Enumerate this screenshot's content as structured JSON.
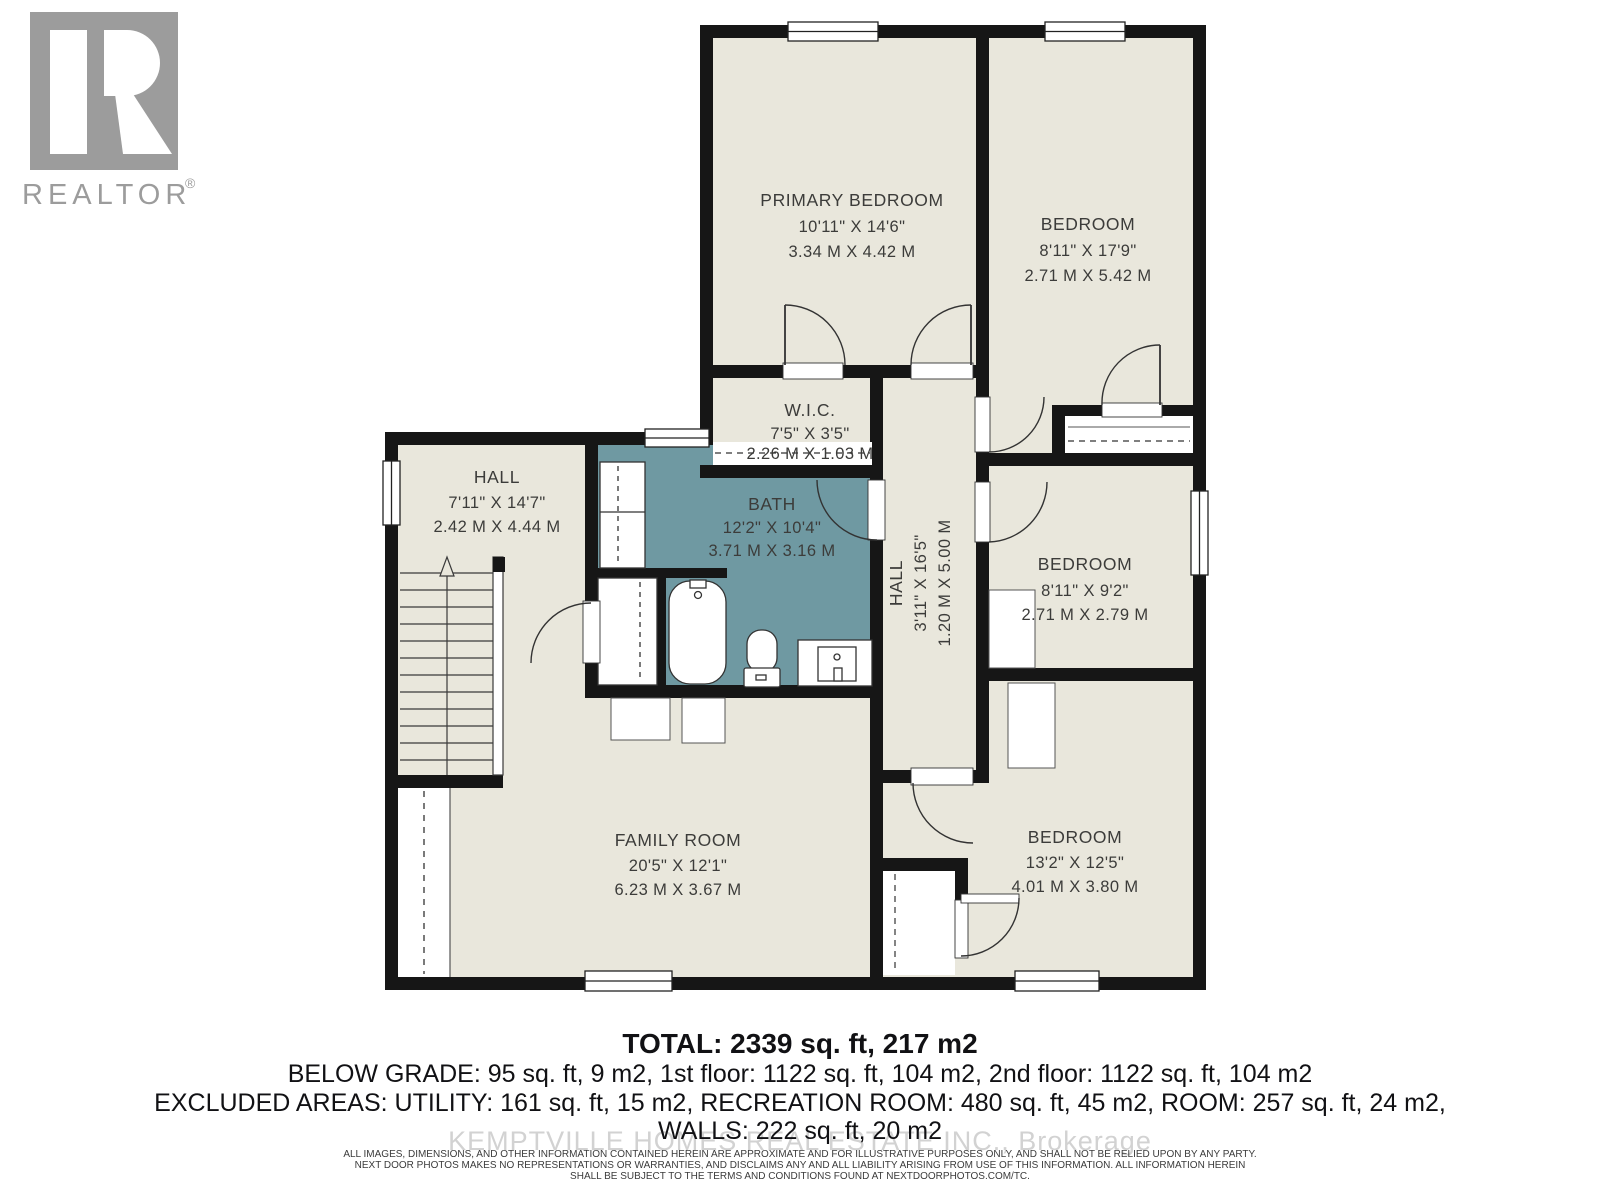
{
  "branding": {
    "logo_text": "REALTOR",
    "registered_mark": "®"
  },
  "rooms": {
    "primary": {
      "name": "PRIMARY BEDROOM",
      "imperial": "10'11\" X 14'6\"",
      "metric": "3.34 M X 4.42 M"
    },
    "bedroom_tr": {
      "name": "BEDROOM",
      "imperial": "8'11\" X 17'9\"",
      "metric": "2.71 M X 5.42 M"
    },
    "wic": {
      "name": "W.I.C.",
      "imperial": "7'5\" X 3'5\"",
      "metric": "2.26 M X 1.03 M"
    },
    "hall_left": {
      "name": "HALL",
      "imperial": "7'11\" X 14'7\"",
      "metric": "2.42 M X 4.44 M"
    },
    "bath": {
      "name": "BATH",
      "imperial": "12'2\" X 10'4\"",
      "metric": "3.71 M X 3.16 M"
    },
    "hall_center": {
      "name": "HALL",
      "imperial": "3'11\" X 16'5\"",
      "metric": "1.20 M X 5.00 M"
    },
    "bedroom_mid": {
      "name": "BEDROOM",
      "imperial": "8'11\" X 9'2\"",
      "metric": "2.71 M X 2.79 M"
    },
    "bedroom_bot": {
      "name": "BEDROOM",
      "imperial": "13'2\" X 12'5\"",
      "metric": "4.01 M X 3.80 M"
    },
    "family": {
      "name": "FAMILY ROOM",
      "imperial": "20'5\" X 12'1\"",
      "metric": "6.23 M X 3.67 M"
    }
  },
  "summary": {
    "total": "TOTAL: 2339 sq. ft, 217 m2",
    "line2": "BELOW GRADE: 95 sq. ft, 9 m2, 1st floor: 1122 sq. ft, 104 m2, 2nd floor: 1122 sq. ft, 104 m2",
    "line3": "EXCLUDED AREAS: UTILITY: 161 sq. ft, 15 m2, RECREATION ROOM: 480 sq. ft, 45 m2, ROOM: 257 sq. ft, 24 m2,",
    "line4": "WALLS: 222 sq. ft, 20 m2"
  },
  "watermark": "KEMPTVILLE HOMES REAL ESTATE INC., Brokerage",
  "disclaimer": {
    "line1": "ALL IMAGES, DIMENSIONS, AND OTHER INFORMATION CONTAINED HEREIN ARE APPROXIMATE AND FOR ILLUSTRATIVE PURPOSES ONLY, AND SHALL NOT BE RELIED UPON BY ANY PARTY.",
    "line2": "NEXT DOOR PHOTOS MAKES NO REPRESENTATIONS OR WARRANTIES, AND DISCLAIMS ANY AND ALL LIABILITY ARISING FROM USE OF THIS INFORMATION. ALL INFORMATION HEREIN",
    "line3": "SHALL BE SUBJECT TO THE TERMS AND CONDITIONS FOUND AT NEXTDOORPHOTOS.COM/TC."
  },
  "colors": {
    "room_fill": "#e9e7dc",
    "bath_fill": "#6f99a2",
    "wall": "#161616",
    "label": "#3c3c3a",
    "logo_gray": "#9c9c9c",
    "watermark_gray": "#d2d2d2"
  }
}
